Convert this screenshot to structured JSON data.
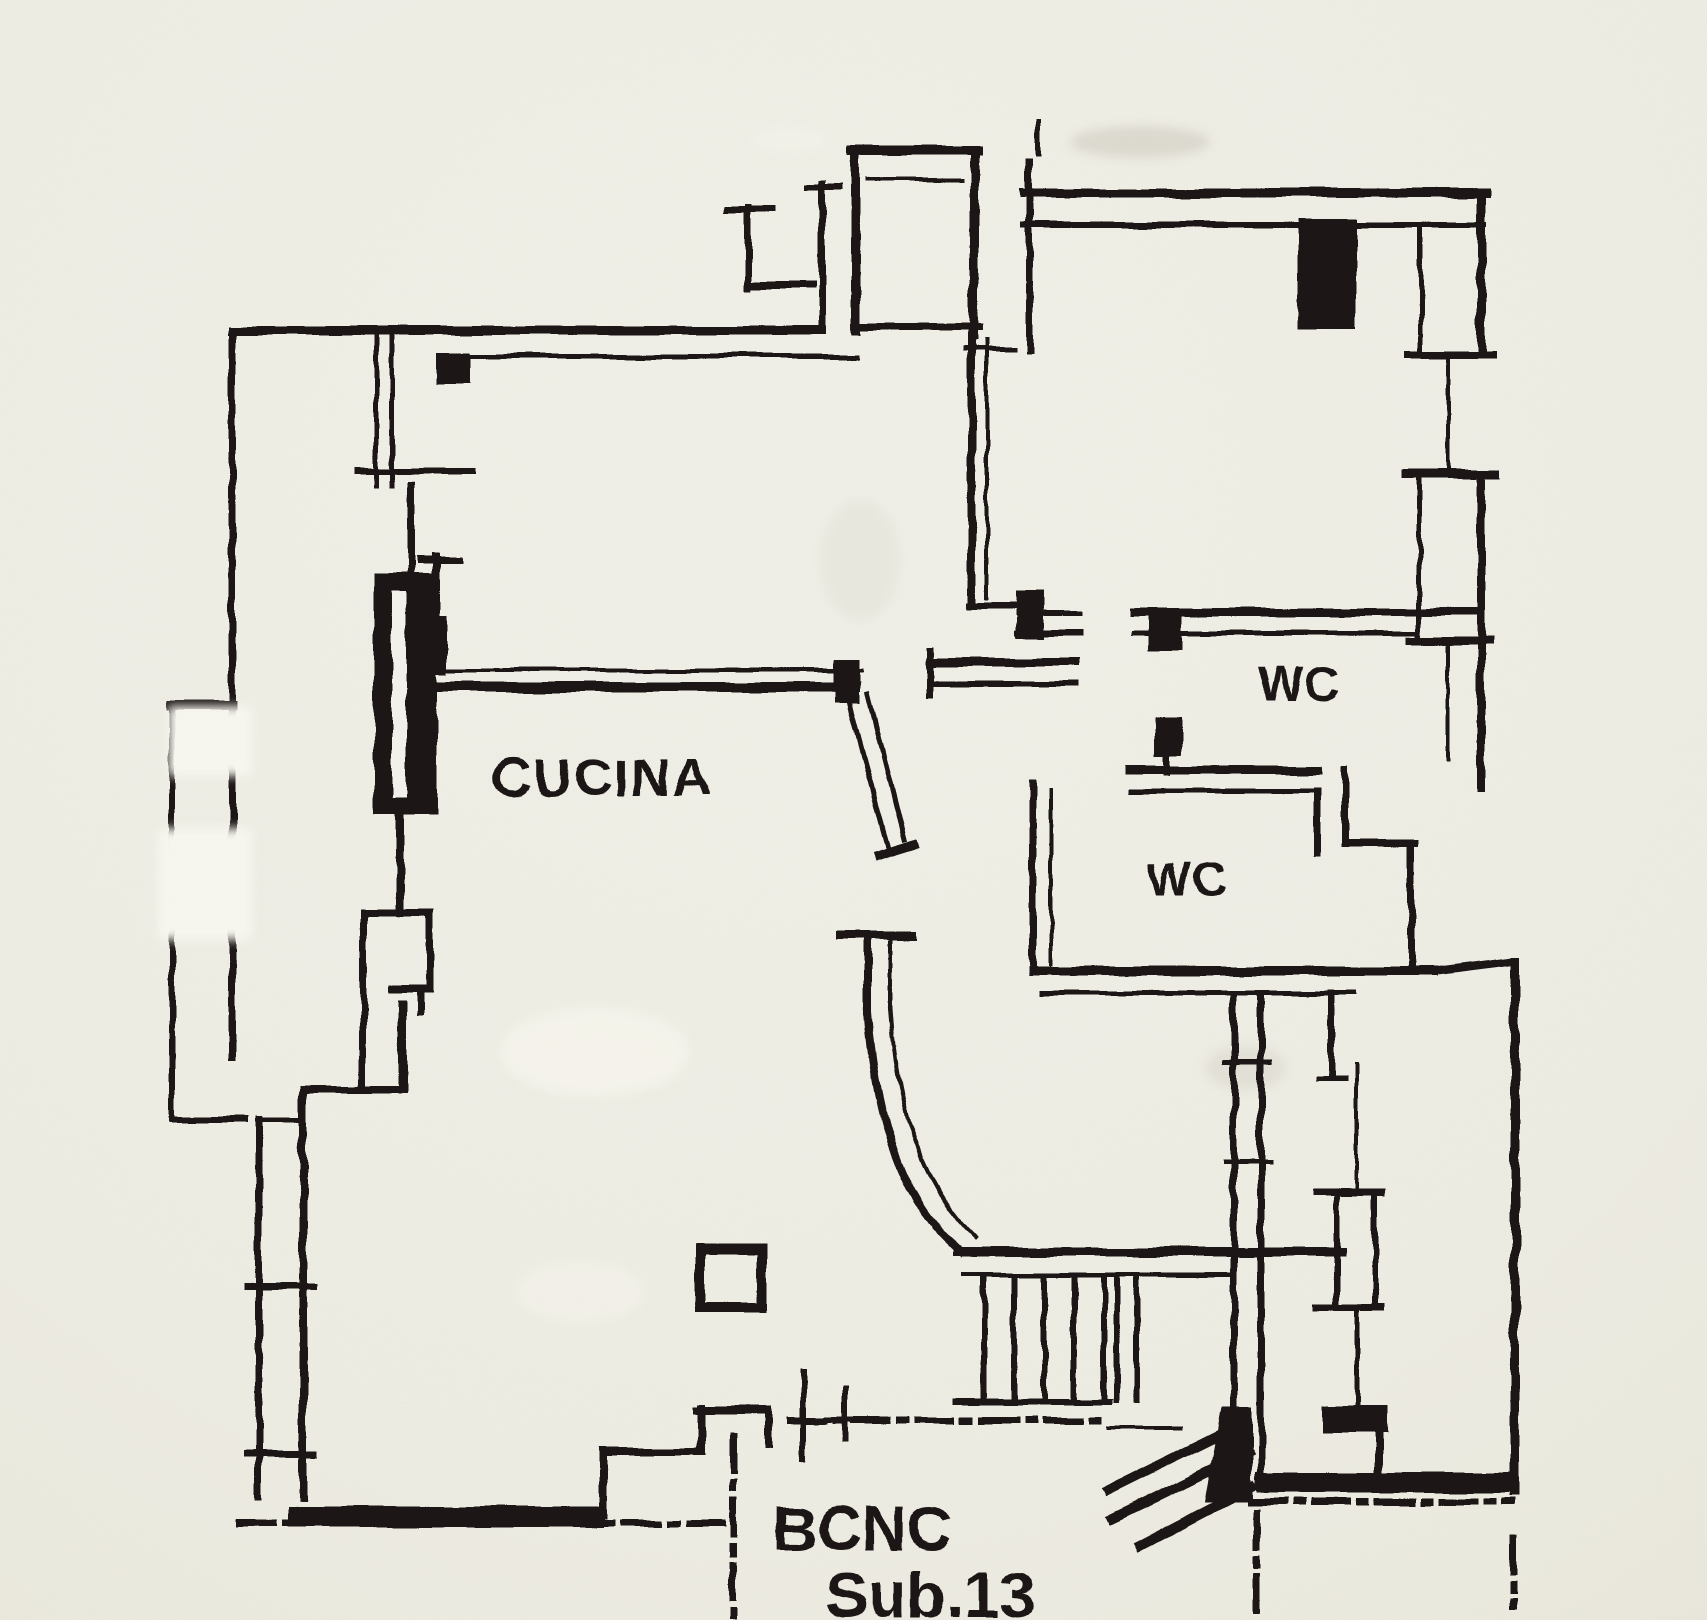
{
  "document": {
    "kind": "scanned-floor-plan",
    "paper_color": "#efeee5",
    "ink_color": "#1d1914",
    "labels": {
      "cucina": "CUCINA",
      "wc_upper": "WC",
      "wc_lower": "WC",
      "bcnc": "BCNC",
      "sub13": "Sub.13"
    },
    "elements": {
      "staircase": "stair flight with treads and hatched winders",
      "door_swing": "open door leaf near kitchen",
      "property_line": "dash-dot boundary line",
      "windows": "double-line window bars in outer walls",
      "corrections": "white-out patches on left terrace"
    }
  }
}
